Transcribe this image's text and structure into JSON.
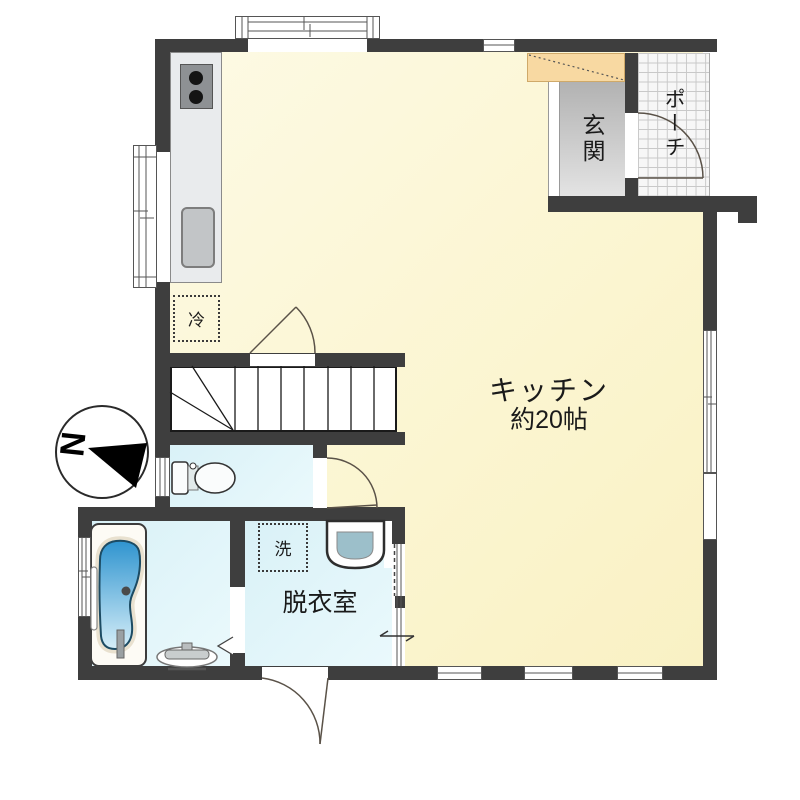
{
  "plan_title": "1F floor plan",
  "labels": {
    "kitchen_name": "キッチン",
    "kitchen_size": "約20帖",
    "entrance": "玄関",
    "porch": "ポーチ",
    "dressing_room": "脱衣室",
    "washing_machine": "洗",
    "refrigerator": "冷",
    "compass_north": "N"
  },
  "colors": {
    "wall": "#3E3E3E",
    "kitchen_floor": "#FBF5D0",
    "wet_room_floor": "#DFF2F7",
    "entrance_floor": "#C9C9C9",
    "shoe_closet": "#F8D9A2",
    "porch_tile": "#F7F7F7",
    "tub_water_top": "#2F94CF",
    "tub_water_bottom": "#D6EEF8"
  }
}
